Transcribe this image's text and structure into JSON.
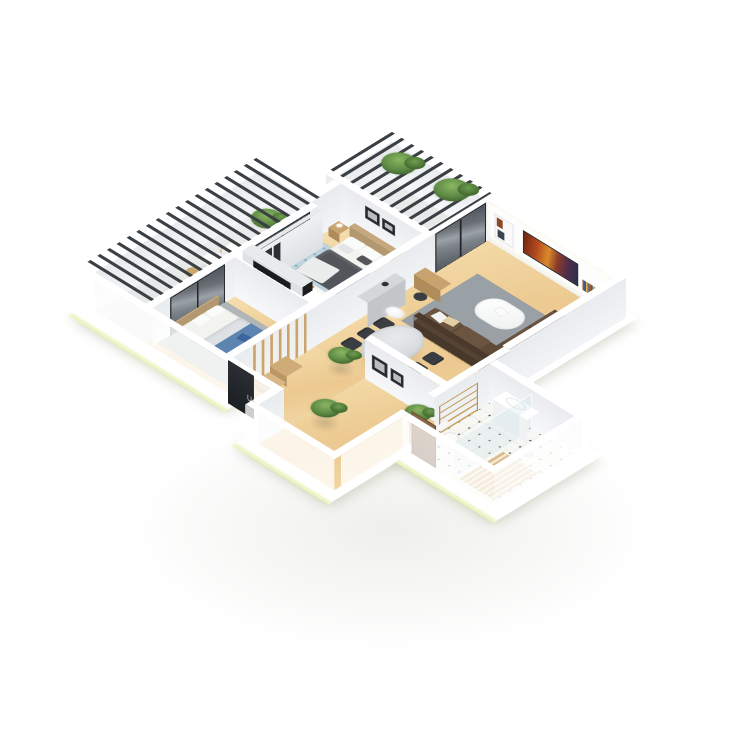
{
  "scene": {
    "label": "3D isometric apartment floor plan render",
    "background": "#ffffff"
  },
  "rooms": [
    {
      "name": "Living room",
      "objects": [
        "media wall with TV",
        "shelf niches",
        "sectional sofa",
        "oval coffee table",
        "gray rug",
        "wood console",
        "floor lamp"
      ]
    },
    {
      "name": "Dining area",
      "objects": [
        "oval marble table",
        "6 dark chairs",
        "pendant lamp",
        "gray sideboard"
      ]
    },
    {
      "name": "Master bedroom",
      "objects": [
        "double bed",
        "wood headboard",
        "nightstands",
        "wall art",
        "blue dotted rug",
        "wardrobe with niches",
        "white console"
      ]
    },
    {
      "name": "Second bedroom",
      "objects": [
        "bed with blue throw",
        "gray rug",
        "wood bench",
        "black TV partition with screen"
      ]
    },
    {
      "name": "Bathroom",
      "objects": [
        "tiled floor",
        "wall-hung sink",
        "toilet",
        "glass shower",
        "wooden shower mat",
        "towel ladder radiator",
        "wood door"
      ]
    },
    {
      "name": "Hallway with stairs",
      "objects": [
        "wooden slat staircase",
        "potted plant"
      ]
    },
    {
      "name": "Entry corridor",
      "objects": [
        "dark entry door",
        "two framed pictures",
        "potted plants"
      ]
    },
    {
      "name": "West balcony",
      "objects": [
        "louvered pergola roof",
        "bistro table",
        "two chairs",
        "potted plant",
        "glass sliding doors"
      ]
    },
    {
      "name": "North balcony",
      "objects": [
        "louvered pergola roof",
        "two plants on pergola",
        "floor pot",
        "glass sliding doors"
      ]
    }
  ],
  "colors": {
    "bg": "#ffffff",
    "wall-top": "#ffffff",
    "floor-wood": "#ecc990",
    "floor-wood-light": "#f3d9a6",
    "balcony-floor": "#e2e4e3",
    "tile-floor": "#f7f7f3",
    "tile-dot": "#46544b",
    "frame-dark": "#24272b",
    "pergola-slat": "#3b4045",
    "rug-gray": "#99a0a6",
    "rug-light": "#b0b5b8",
    "rug-blue": "#bed5df",
    "rug-blue-dot": "#7fa9ba",
    "sofa": "#5e4a37",
    "sofa-dark": "#4b3a2b",
    "sofa-light": "#6b5440",
    "wood": "#c9a36f",
    "wood-dark": "#47382a",
    "marble": "#d9dcdf",
    "chair-dark": "#3a3d41",
    "duvet-dark": "#53555c",
    "linen": "#f3f3f0",
    "accent-blue": "#5d83b0",
    "plant-green": "#5d8a44",
    "plant-dark": "#3a5c2c",
    "door-wood": "#7a5c3f",
    "glow-green": "#dfe98c",
    "tv-warm-1": "#6e2310",
    "tv-warm-2": "#d98a2b",
    "tv-cool": "#27324e"
  }
}
